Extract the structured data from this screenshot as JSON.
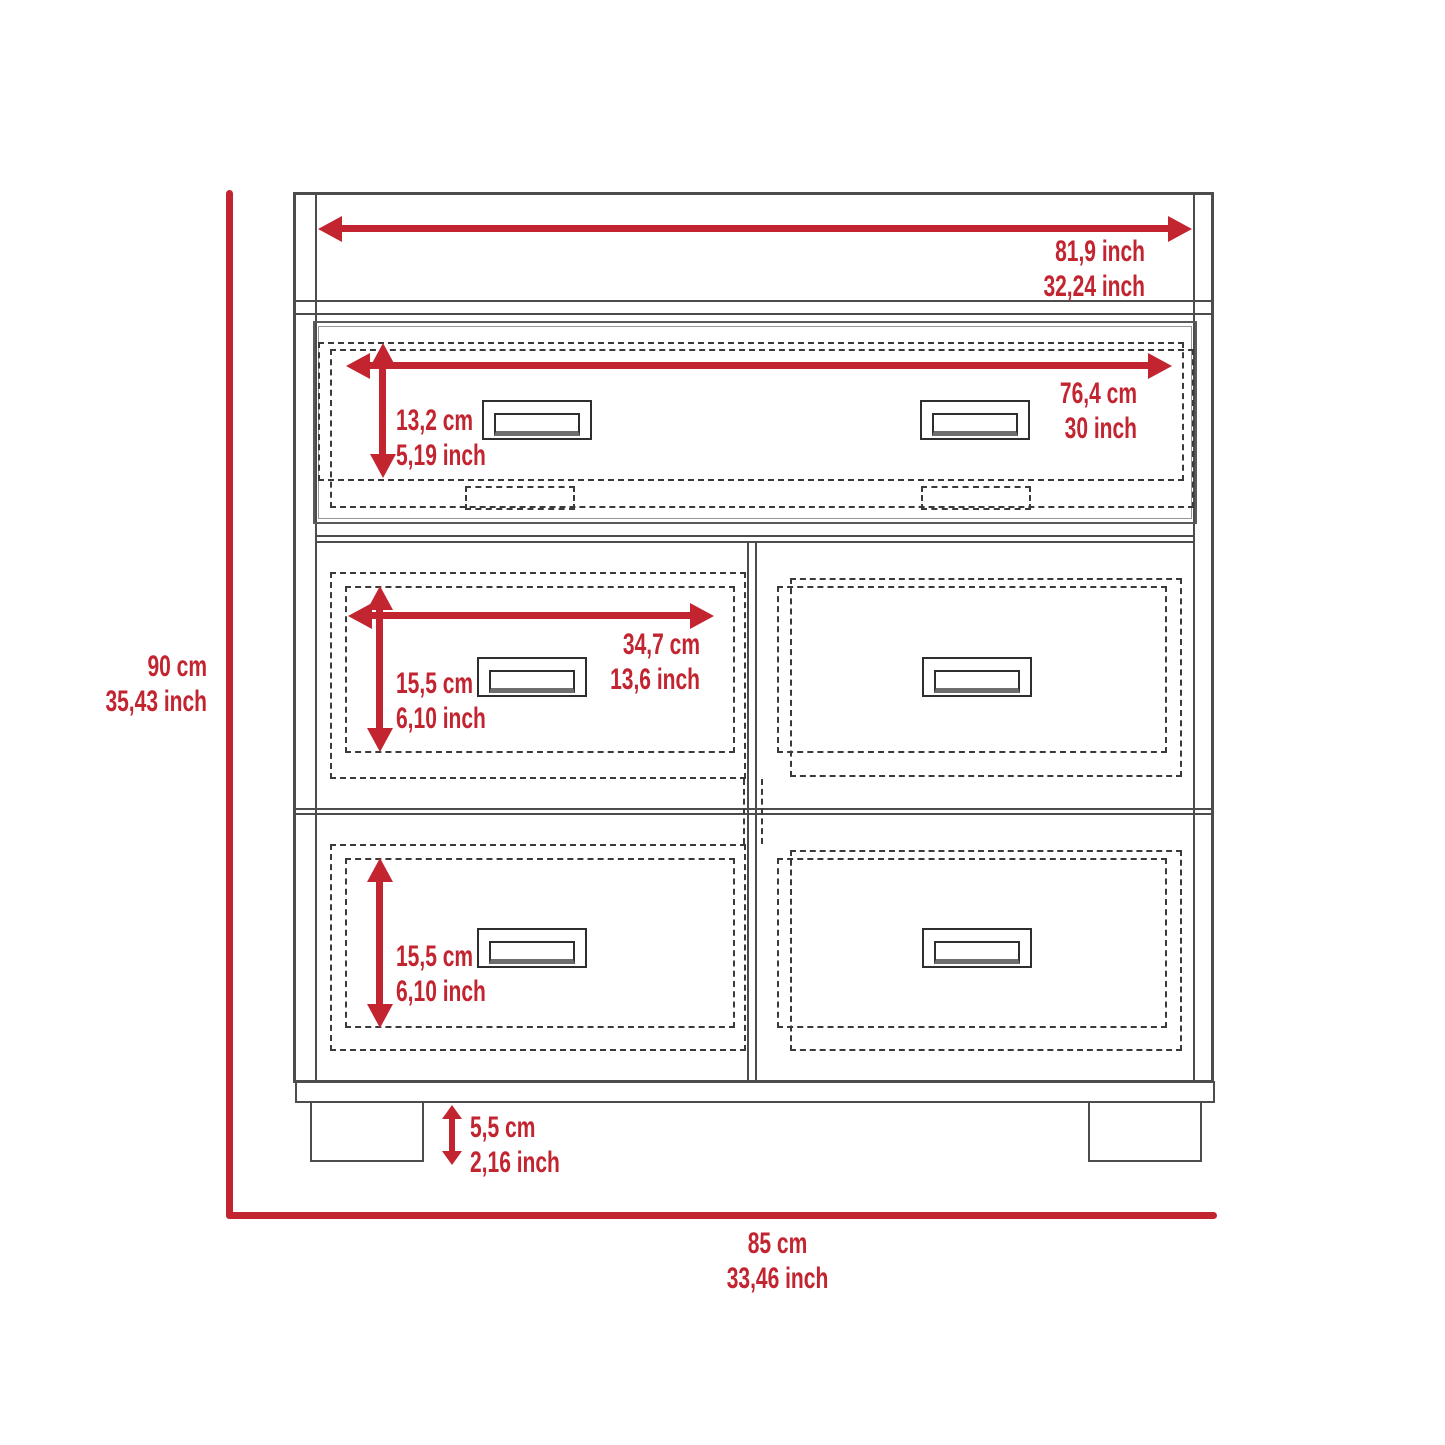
{
  "diagram": {
    "accent_color": "#c22430",
    "outline_color": "#4c4c4c",
    "subject": "dresser-dimension-diagram"
  },
  "dimensions": {
    "top_width": {
      "line1": "81,9 inch",
      "line2": "32,24 inch"
    },
    "top_drawer_width": {
      "line1": "76,4 cm",
      "line2": "30 inch"
    },
    "top_drawer_height": {
      "line1": "13,2 cm",
      "line2": "5,19 inch"
    },
    "middle_drawer_width": {
      "line1": "34,7 cm",
      "line2": "13,6 inch"
    },
    "middle_drawer_height": {
      "line1": "15,5 cm",
      "line2": "6,10 inch"
    },
    "bottom_drawer_height": {
      "line1": "15,5 cm",
      "line2": "6,10 inch"
    },
    "leg_height": {
      "line1": "5,5 cm",
      "line2": "2,16 inch"
    },
    "overall_height": {
      "line1": "90 cm",
      "line2": "35,43 inch"
    },
    "overall_width": {
      "line1": "85 cm",
      "line2": "33,46 inch"
    }
  }
}
